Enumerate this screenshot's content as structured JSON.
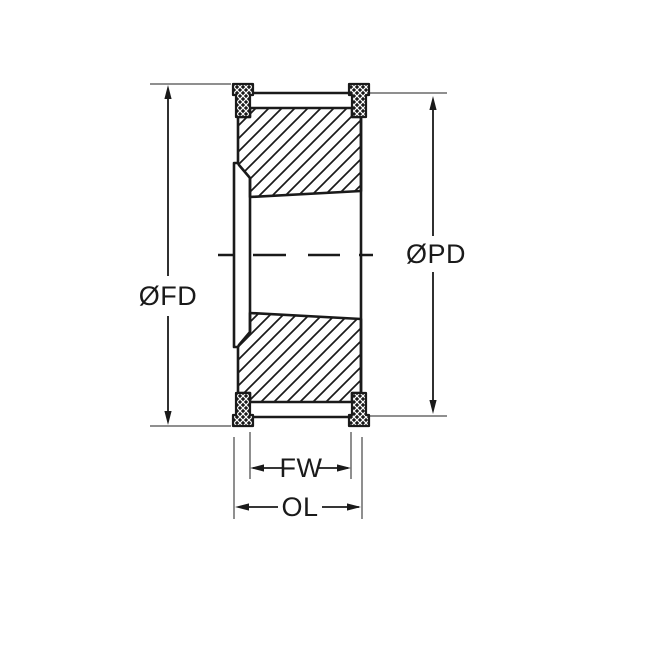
{
  "drawing": {
    "labels": {
      "flange_diameter": "ØFD",
      "pitch_diameter": "ØPD",
      "face_width": "FW",
      "overall_length": "OL"
    },
    "colors": {
      "line": "#1a1a1a",
      "extension_line": "#8f8f8f",
      "background": "#ffffff"
    }
  }
}
